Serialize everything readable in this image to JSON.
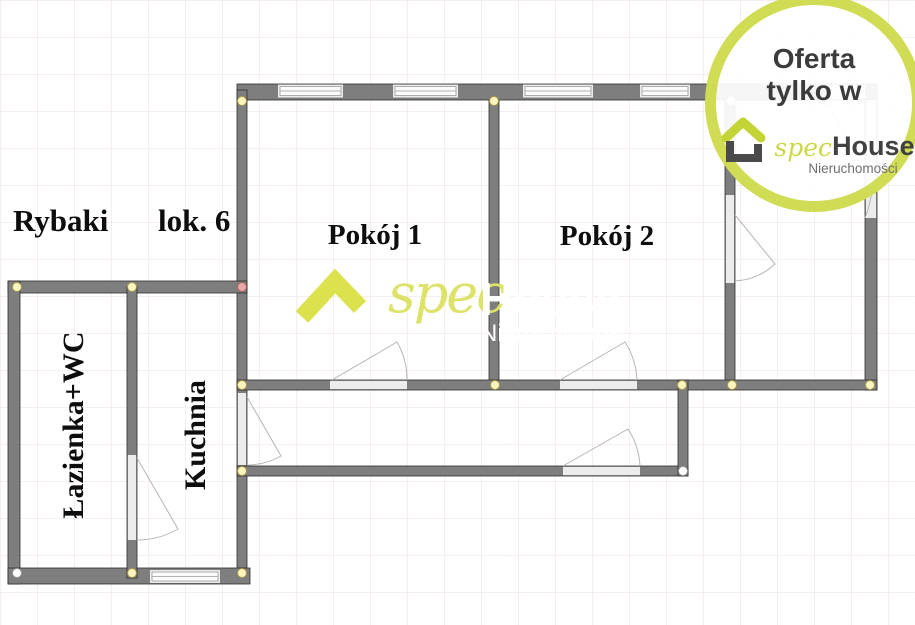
{
  "plan": {
    "address": "Rybaki",
    "unit": "lok. 6",
    "rooms": [
      {
        "label": "Pokój 1"
      },
      {
        "label": "Pokój 2"
      },
      {
        "label": "Łazienka+WC"
      },
      {
        "label": "Kuchnia"
      }
    ]
  },
  "watermark": {
    "spec": "spec",
    "house": "House",
    "subtitle": "Nieruchomości"
  },
  "badge": {
    "line1": "Oferta",
    "line2": "tylko w",
    "brand_spec": "spec",
    "brand_house": "House",
    "brand_subtitle": "Nieruchomości"
  },
  "colors": {
    "accent_lime": "#ccd843",
    "watermark_lime": "#dde269",
    "wall_gray": "#7e7e7e",
    "opening_gray": "#ececec",
    "text_dark": "#3b3b3b",
    "node_yellow": "#fdf5bd",
    "node_pink": "#e8a8a8"
  }
}
